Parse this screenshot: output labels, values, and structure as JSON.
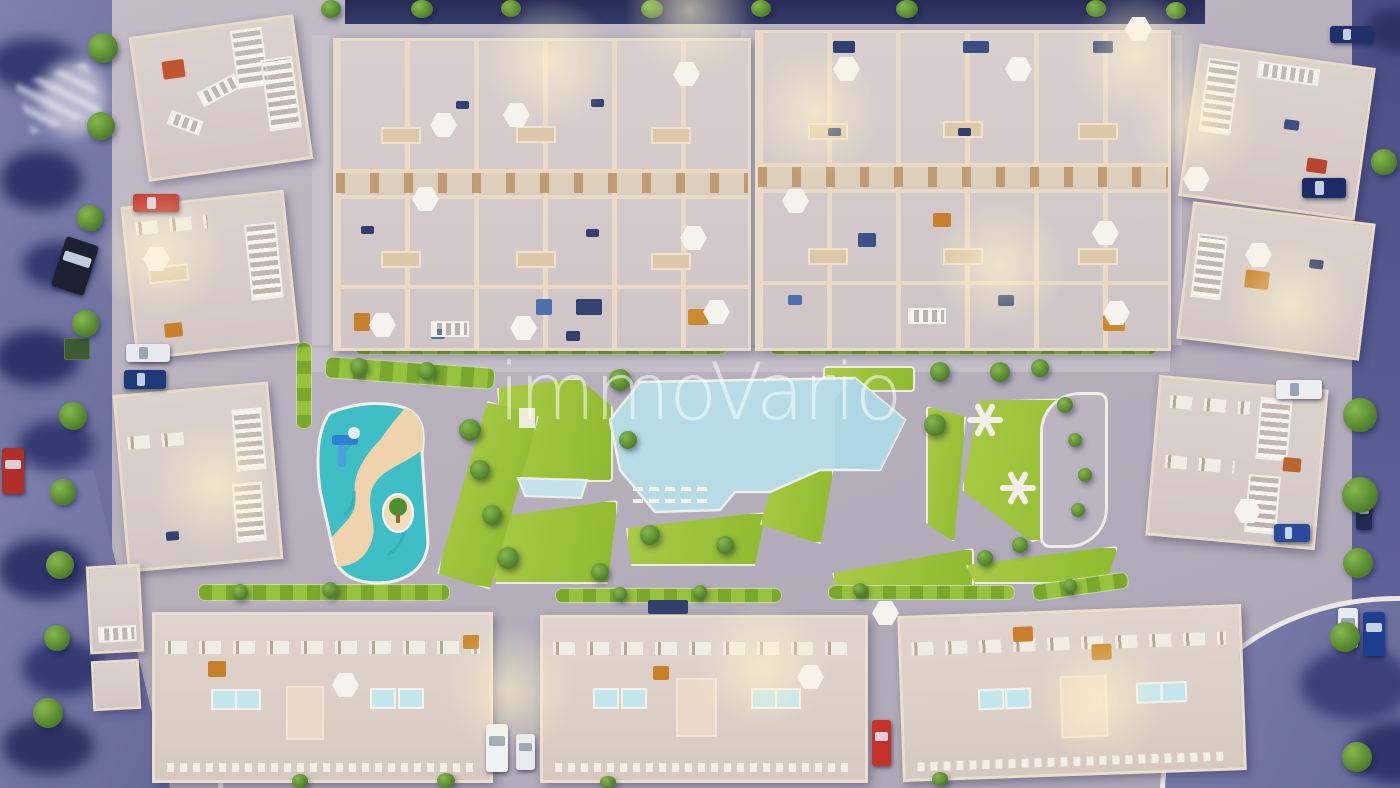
{
  "watermark": {
    "text": "immoVario"
  },
  "palette": {
    "outside_dusk_purple": "#7073a2",
    "night_navy": "#2d3361",
    "street_gray": "#b8b1bd",
    "building_cream": "#e9dbc8",
    "roof_gray": "#d5cbc9",
    "railing_white": "#f6f3ee",
    "grass_green": "#9cc23c",
    "lagoon_blue": "#b7dce6",
    "splash_teal": "#3fbec6",
    "sand_beige": "#eed3ac",
    "glow_warm": "#fff3cb",
    "watermark_white": "#ffffff"
  },
  "scene": {
    "description": "Aerial dusk 3D render of a residential complex",
    "features": [
      "rooftop-terraces-with-parasols",
      "central-lagoon-pool",
      "children-splash-river-pool",
      "lawns-with-play-structures",
      "sun-loungers",
      "rooftop-plunge-pools",
      "parked-cars",
      "street-trees",
      "warm-street-lights"
    ],
    "car_colors": [
      "red",
      "black",
      "white",
      "navy",
      "blue",
      "green-dumpster"
    ]
  }
}
